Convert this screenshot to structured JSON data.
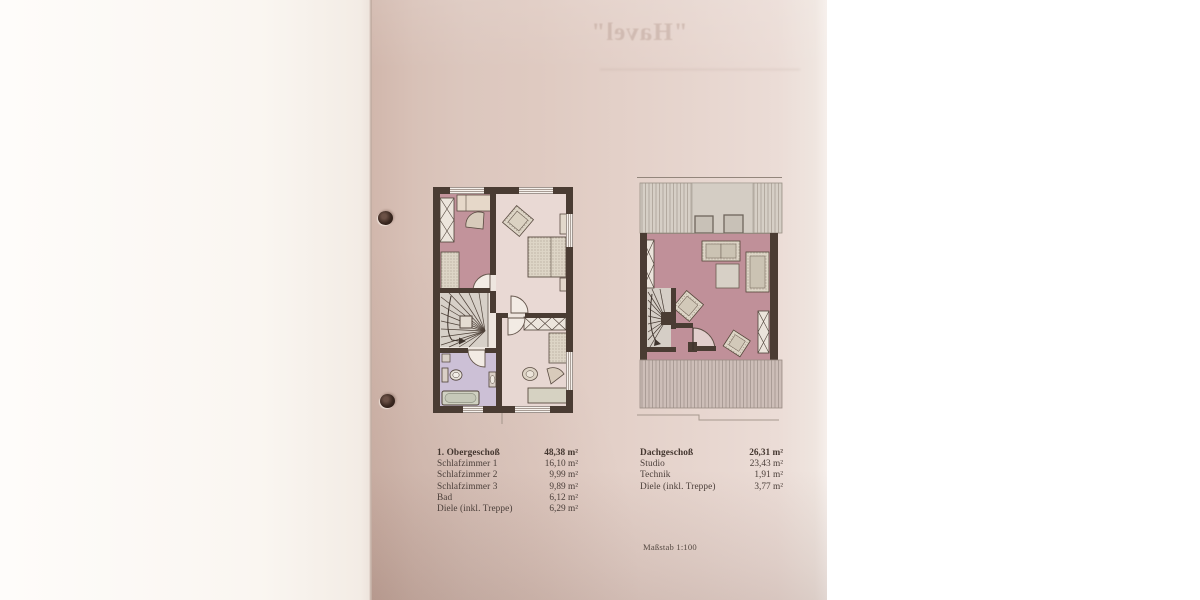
{
  "photo": {
    "ghost_title": "\"Havel\"",
    "scale_note": "Maßstab 1:100"
  },
  "tables": {
    "obergeschoss": {
      "header": {
        "label": "1. Obergeschoß",
        "value": "48,38 m²"
      },
      "rows": [
        {
          "label": "Schlafzimmer 1",
          "value": "16,10 m²"
        },
        {
          "label": "Schlafzimmer 2",
          "value": "9,99 m²"
        },
        {
          "label": "Schlafzimmer 3",
          "value": "9,89 m²"
        },
        {
          "label": "Bad",
          "value": "6,12 m²"
        },
        {
          "label": "Diele (inkl. Treppe)",
          "value": "6,29 m²"
        }
      ]
    },
    "dachgeschoss": {
      "header": {
        "label": "Dachgeschoß",
        "value": "26,31 m²"
      },
      "rows": [
        {
          "label": "Studio",
          "value": "23,43 m²"
        },
        {
          "label": "Technik",
          "value": "1,91 m²"
        },
        {
          "label": "Diele (inkl. Treppe)",
          "value": "3,77 m²"
        }
      ]
    }
  },
  "colors": {
    "page": "#dcc7be",
    "wall": "#4a3c33",
    "room_rose": "#c2939b",
    "room_light": "#e9d9d4",
    "bathroom_lavender": "#ccc0d6",
    "roof_hatch": "#d6cfc6",
    "text": "#4a3e39"
  }
}
